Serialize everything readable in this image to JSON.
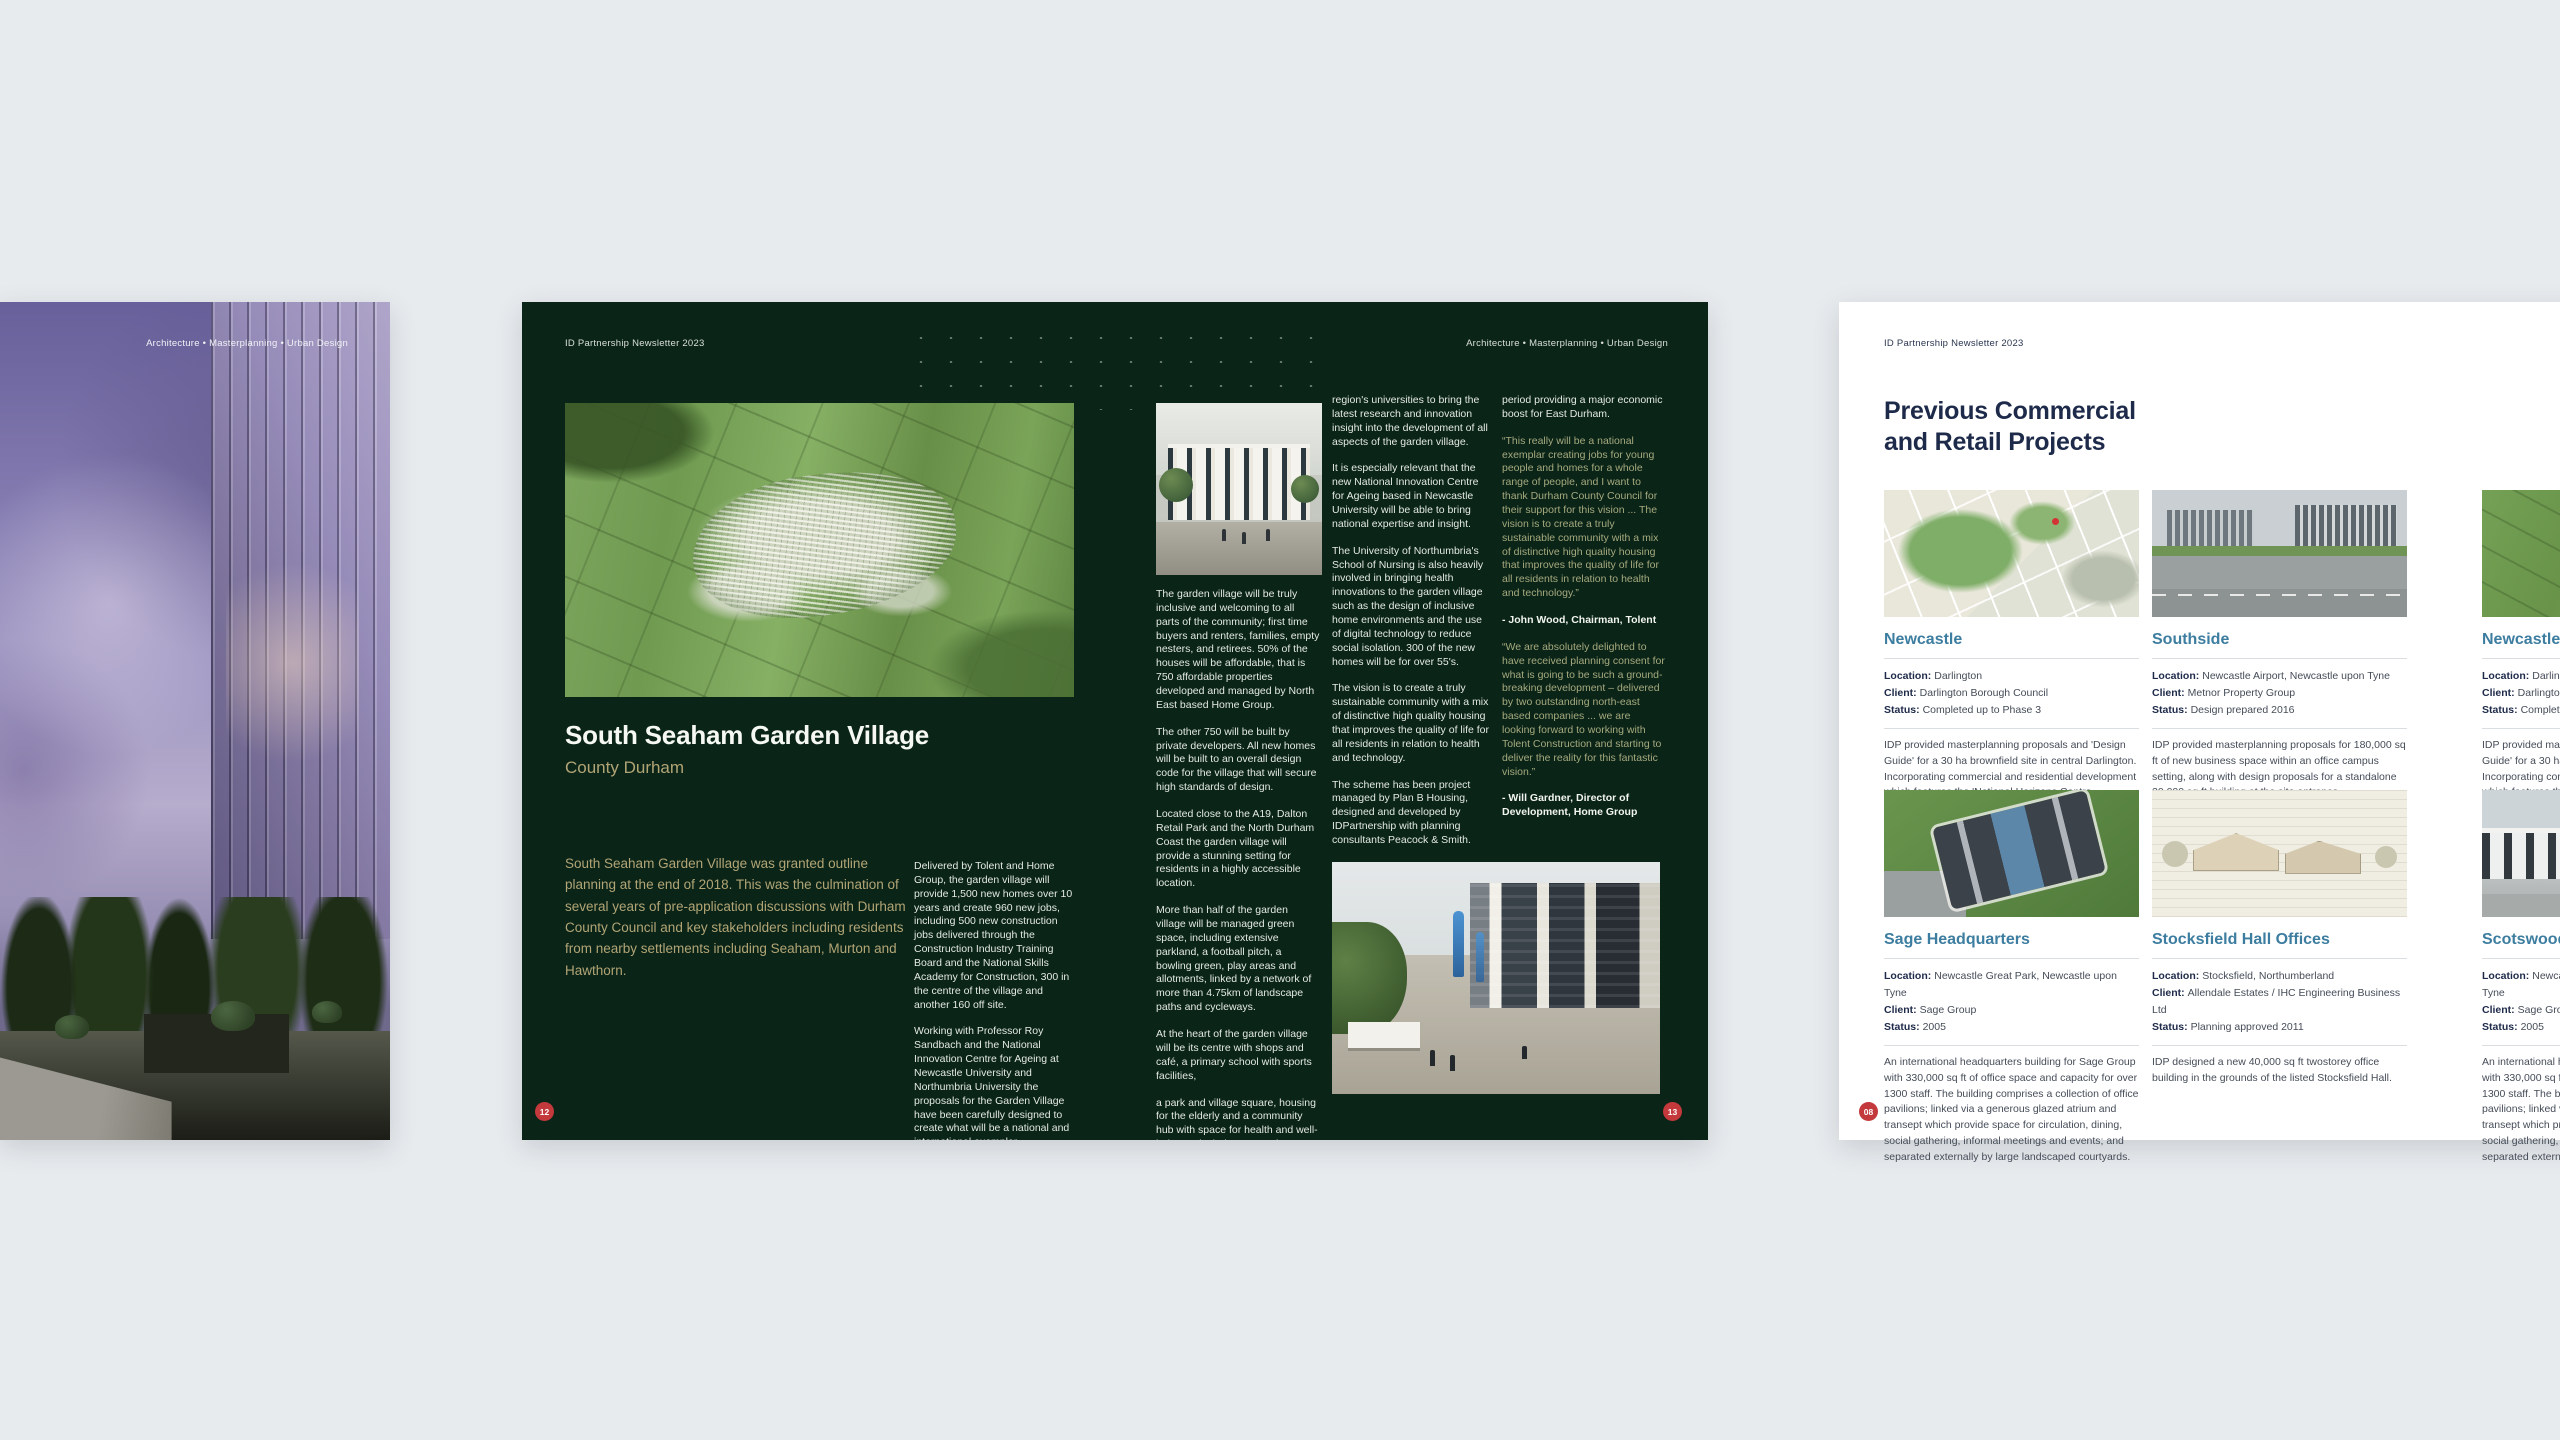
{
  "colors": {
    "canvas_bg": "#e8ebee",
    "green_spread_bg": "#0a2418",
    "accent_tan": "#b2a575",
    "quote_green": "#a6aa7e",
    "page_number_red": "#c3393c",
    "navy_text": "#1e2a4a",
    "card_title_teal": "#3c7da0"
  },
  "left_page": {
    "header_right": "Architecture • Masterplanning • Urban Design"
  },
  "green_spread": {
    "header_left": "ID Partnership Newsletter 2023",
    "header_right": "Architecture • Masterplanning • Urban Design",
    "title": "South Seaham Garden Village",
    "subtitle": "County Durham",
    "intro": "South Seaham Garden Village was granted outline planning at the end of 2018. This was the culmination of several years of pre-application discussions with Durham County Council and key stakeholders including residents from nearby settlements including Seaham, Murton and Hawthorn.",
    "col1_paras": [
      "Delivered by Tolent and Home Group, the garden village will provide 1,500 new homes over 10 years and create 960 new jobs, including 500 new construction jobs delivered through the Construction Industry Training Board and the National Skills Academy for Construction, 300 in the centre of the village and another 160 off site.",
      "Working with Professor Roy Sandbach and the National Innovation Centre for Ageing at Newcastle University and Northumbria University the proposals for the Garden Village have been carefully designed to create what will be a national and international exemplar."
    ],
    "col2_paras": [
      "The garden village will be truly inclusive and welcoming to all parts of the community; first time buyers and renters, families, empty nesters, and retirees. 50% of the houses will be affordable, that is 750 affordable properties developed and managed by North East based Home Group.",
      "The other 750 will be built by private developers. All new homes will be built to an overall design code for the village that will secure high standards of design.",
      "Located close to the A19, Dalton Retail Park and the North Durham Coast the garden village will provide a stunning setting for residents in a highly accessible location.",
      "More than half of the garden village will be managed green space, including extensive parkland, a football pitch, a bowling green, play areas and allotments, linked by a network of more than 4.75km of landscape paths and cycleways.",
      "At the heart of the garden village will be its centre with shops and café, a primary school with sports facilities,",
      "a park and village square, housing for the elderly and a community hub with space for health and well-being, to include a gym. The village centre will also include a new innovation hub for business space.",
      "The innovation hub will be used by new and existing businesses, along with the"
    ],
    "col3_paras": [
      "region's universities to bring the latest research and innovation insight into the development of all aspects of the garden village.",
      "It is especially relevant that the new National Innovation Centre for Ageing based in Newcastle University will be able to bring national expertise and insight.",
      "The University of Northumbria's School of Nursing is also heavily involved in bringing health innovations to the garden village such as the design of inclusive home environments and the use of digital technology to reduce social isolation. 300 of the new homes will be for over 55's.",
      "The vision is to create a truly sustainable community with a mix of distinctive high quality housing that improves the quality of life for all residents in relation to health and technology.",
      "The scheme has been project managed by Plan B Housing, designed and developed by IDPartnership with planning consultants Peacock & Smith.",
      "Work is due to commence on site in the summer of 2019 with the first new homes being available in early 2020. The garden village will be developed over a 10 year"
    ],
    "col4": {
      "lead": "period providing a major economic boost for East Durham.",
      "quote1": "“This really will be a national exemplar creating jobs for young people and homes for a whole range of people, and I want to thank Durham County Council for their support for this vision ... The vision is to create a truly sustainable community with a mix of distinctive high quality housing that improves the quality of life for all residents in relation to health and technology.”",
      "attribution1": "- John Wood, Chairman, Tolent",
      "quote2": "“We are absolutely delighted to have received planning consent for what is going to be such a ground-breaking development – delivered by two outstanding north-east based companies ... we are looking forward to working with Tolent Construction and starting to deliver the reality for this fantastic vision.”",
      "attribution2": "- Will Gardner, Director of Development, Home Group"
    },
    "page_number_left": "12",
    "page_number_right": "13"
  },
  "white_spread": {
    "header_left": "ID Partnership Newsletter 2023",
    "title": "Previous Commercial and Retail Projects",
    "page_number": "08",
    "labels": {
      "location": "Location:",
      "client": "Client:",
      "status": "Status:"
    },
    "cards": [
      {
        "title": "Newcastle",
        "location": "Darlington",
        "client": "Darlington Borough Council",
        "status": "Completed up to Phase 3",
        "description": "IDP provided masterplanning proposals and 'Design Guide' for a 30 ha brownfield site in central Darlington. Incorporating commercial and residential development which features the 'National Horizons Centre"
      },
      {
        "title": "Southside",
        "location": "Newcastle Airport, Newcastle upon Tyne",
        "client": "Metnor Property Group",
        "status": "Design prepared 2016",
        "description": "IDP provided masterplanning proposals for 180,000 sq ft of new business space within an office campus setting, along with design proposals for a standalone 20,000 sq ft building at the site entrance."
      },
      {
        "title": "Newcastle F",
        "location": "Darlington",
        "client": "Darlington Borough Council",
        "status": "Completed up to Phase 3",
        "description": "IDP provided masterplanning proposals and 'Design Guide' for a 30 ha brownfield site in central Darlington. Incorporating commercial and residential development which features the 'National Horizons Centre"
      },
      {
        "title": "Sage Headquarters",
        "location": "Newcastle Great Park, Newcastle upon Tyne",
        "client": "Sage Group",
        "status": "2005",
        "description": "An international headquarters building for Sage Group with 330,000 sq ft of office space and capacity for over 1300 staff. The building comprises a collection of office pavilions; linked via a generous glazed atrium and transept which provide space for circulation, dining, social gathering, informal meetings and events; and separated externally by large landscaped courtyards."
      },
      {
        "title": "Stocksfield Hall Offices",
        "location": "Stocksfield, Northumberland",
        "client": "Allendale Estates / IHC Engineering Business Ltd",
        "status": "Planning approved 2011",
        "description": "IDP designed a new 40,000 sq ft twostorey office building in the grounds of the listed Stocksfield Hall."
      },
      {
        "title": "Scotswood",
        "location": "Newcastle Great Park, Newcastle upon Tyne",
        "client": "Sage Group",
        "status": "2005",
        "description": "An international headquarters building for Sage Group with 330,000 sq ft of office space and capacity for over 1300 staff. The building comprises a collection of office pavilions; linked via a generous glazed atrium and transept which provide space for circulation, dining, social gathering, informal meetings and events; and separated externally by large landscaped courtyards."
      }
    ]
  }
}
